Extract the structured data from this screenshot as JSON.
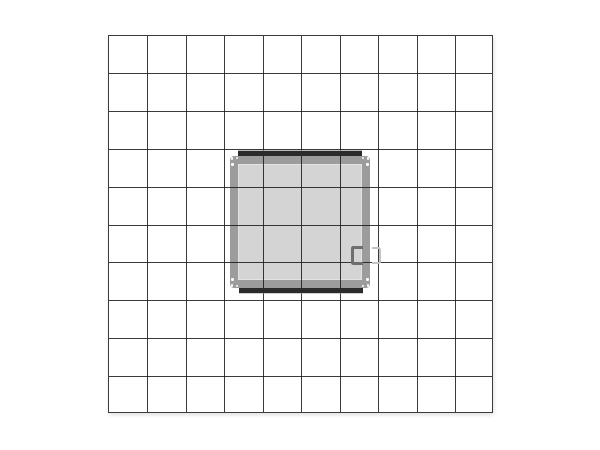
{
  "meta": {
    "description": "Plan (top) view technical drawing of a square exhibit structure centered on 10x10 grid paper",
    "visible_text": ""
  },
  "canvas": {
    "width": 600,
    "height": 450,
    "background": "#ffffff"
  },
  "grid": {
    "left": 108,
    "top": 35,
    "columns": 10,
    "rows": 10,
    "cell_width": 38.5,
    "cell_height": 37.8,
    "line_width": 1,
    "line_color": "rgba(25,25,25,0.85)",
    "border_color": "rgba(25,25,25,0.85)",
    "drop_shadow": "1px 2px 4px rgba(0,0,0,0.12)"
  },
  "structure": {
    "frame": {
      "left": 230,
      "top": 156,
      "width": 140,
      "height": 132,
      "wall_thickness": 8,
      "wall_color": "#9c9c9c",
      "panel_color": "#d4d4d4",
      "corner_radius": 4,
      "inner_highlight": "inset 0 0 0 1px rgba(255,255,255,0.35)"
    },
    "top_bar": {
      "left": 238,
      "top": 151,
      "width": 124,
      "height": 5,
      "color": "#2b2b2b",
      "highlight": "0 -1px 0 rgba(160,160,160,0.7)"
    },
    "bottom_bar": {
      "left": 239,
      "top": 288,
      "width": 124,
      "height": 5,
      "color": "#2b2b2b",
      "highlight": "0 1px 0 rgba(160,160,160,0.5)"
    },
    "inner_handle": {
      "left": 351,
      "top": 245.5,
      "width": 12,
      "height": 19,
      "stroke": 3,
      "color": "#6e6e6e",
      "opening": "right",
      "radius": 2.5
    },
    "outer_handle": {
      "left": 371.5,
      "top": 246.5,
      "width": 9,
      "height": 17,
      "stroke": 2.5,
      "color": "#c3c3c3",
      "opening": "left",
      "radius": 2.5
    },
    "corner_bolts": {
      "size": 2.2,
      "color": "#ffffff",
      "opacity": 0.95,
      "offsets": [
        [
          2,
          2.5
        ],
        [
          2.5,
          8.5
        ],
        [
          7,
          2
        ]
      ]
    }
  }
}
